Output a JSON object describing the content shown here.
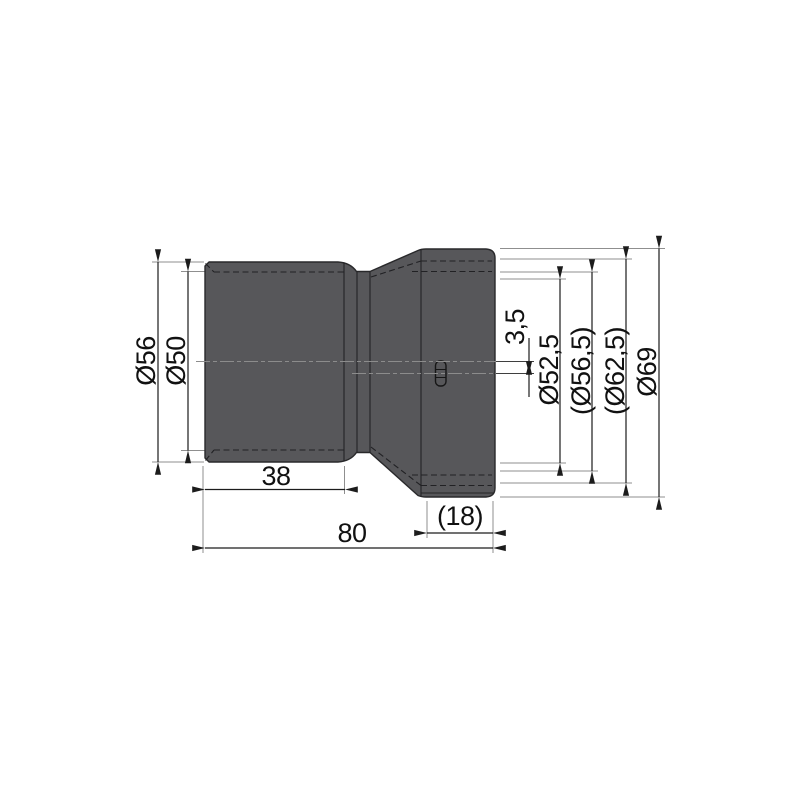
{
  "drawing": {
    "type": "technical-dimension-drawing",
    "part": "eccentric-pipe-reducer",
    "colors": {
      "background": "#ffffff",
      "body": "#57575a",
      "outline": "#29292b",
      "dimension_line": "#1c1c1c",
      "extension_line": "#8f8f8f",
      "centerline": "#8c8c8c"
    },
    "dimensions": {
      "outer_diameter_left": "Ø56",
      "bore_diameter_left": "Ø50",
      "spigot_length": "38",
      "overall_length": "80",
      "socket_depth": "(18)",
      "axis_offset": "3,5",
      "socket_bore_diameter": "Ø52,5",
      "socket_middle_diameter": "(Ø56,5)",
      "socket_outer_bore_diameter": "(Ø62,5)",
      "outer_diameter_right": "Ø69"
    }
  }
}
